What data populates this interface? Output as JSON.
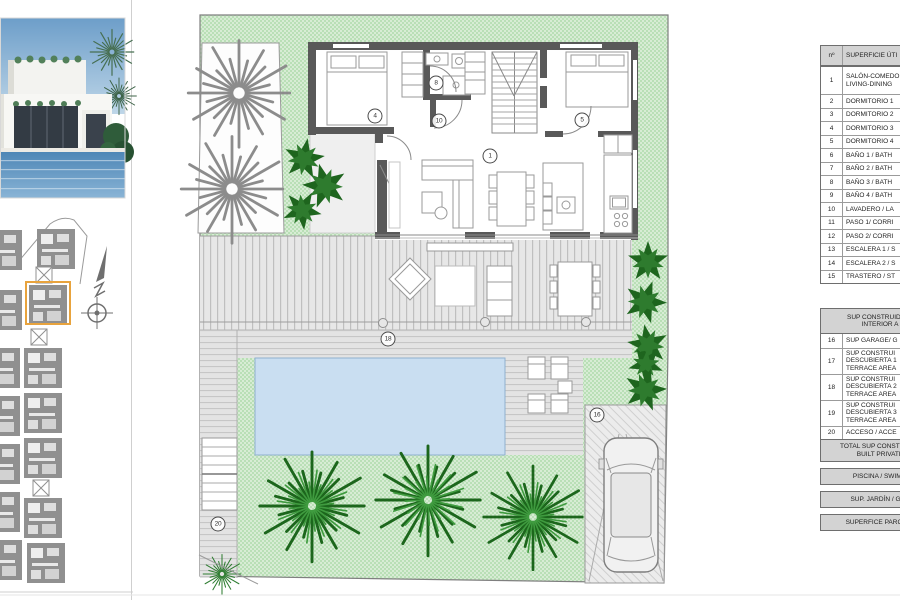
{
  "legend_table": {
    "header": {
      "number_col": "nº",
      "desc_col": "SUPERFICIE ÚTI"
    },
    "rows": [
      {
        "num": "1",
        "desc": "SALÓN-COMEDO\nLIVING-DINING"
      },
      {
        "num": "2",
        "desc": "DORMITORIO 1"
      },
      {
        "num": "3",
        "desc": "DORMITORIO 2"
      },
      {
        "num": "4",
        "desc": "DORMITORIO 3"
      },
      {
        "num": "5",
        "desc": "DORMITORIO 4"
      },
      {
        "num": "6",
        "desc": "BAÑO 1 / BATH"
      },
      {
        "num": "7",
        "desc": "BAÑO 2 / BATH"
      },
      {
        "num": "8",
        "desc": "BAÑO 3 / BATH"
      },
      {
        "num": "9",
        "desc": "BAÑO 4 / BATH"
      },
      {
        "num": "10",
        "desc": "LAVADERO / LA"
      },
      {
        "num": "11",
        "desc": "PASO 1/ CORRI"
      },
      {
        "num": "12",
        "desc": "PASO 2/ CORRI"
      },
      {
        "num": "13",
        "desc": "ESCALERA 1 / S"
      },
      {
        "num": "14",
        "desc": "ESCALERA 2 / S"
      },
      {
        "num": "15",
        "desc": "TRASTERO / ST"
      }
    ],
    "built_header": "SUP CONSTRUIDA IN\nINTERIOR A",
    "built_rows": [
      {
        "num": "16",
        "desc": "SUP GARAGE/ G"
      },
      {
        "num": "17",
        "desc": "SUP CONSTRUI\nDESCUBIERTA 1\nTERRACE AREA"
      },
      {
        "num": "18",
        "desc": "SUP CONSTRUI\nDESCUBIERTA 2\nTERRACE AREA"
      },
      {
        "num": "19",
        "desc": "SUP CONSTRUI\nDESCUBIERTA 3\nTERRACE AREA"
      },
      {
        "num": "20",
        "desc": "ACCESO / ACCE"
      }
    ],
    "total_row": "TOTAL SUP CONSTRUIDA\nBUILT PRIVATE",
    "summary_rows": [
      "PISCINA / SWIMM",
      "SUP. JARDÍN / GAR",
      "SUPERFICE PARCELA"
    ]
  },
  "plan_labels": {
    "living_dining": "1",
    "bedroom_left": "4",
    "bedroom_right": "5",
    "bathroom": "8",
    "hallway": "10",
    "garage": "16",
    "terrace": "18",
    "access": "20"
  },
  "colors": {
    "wall_gray": "#595959",
    "garden_green": "#d7ecd4",
    "plant_green": "#1e651e",
    "pool_blue": "#c9def1",
    "highlight_orange": "#e8a33d"
  }
}
